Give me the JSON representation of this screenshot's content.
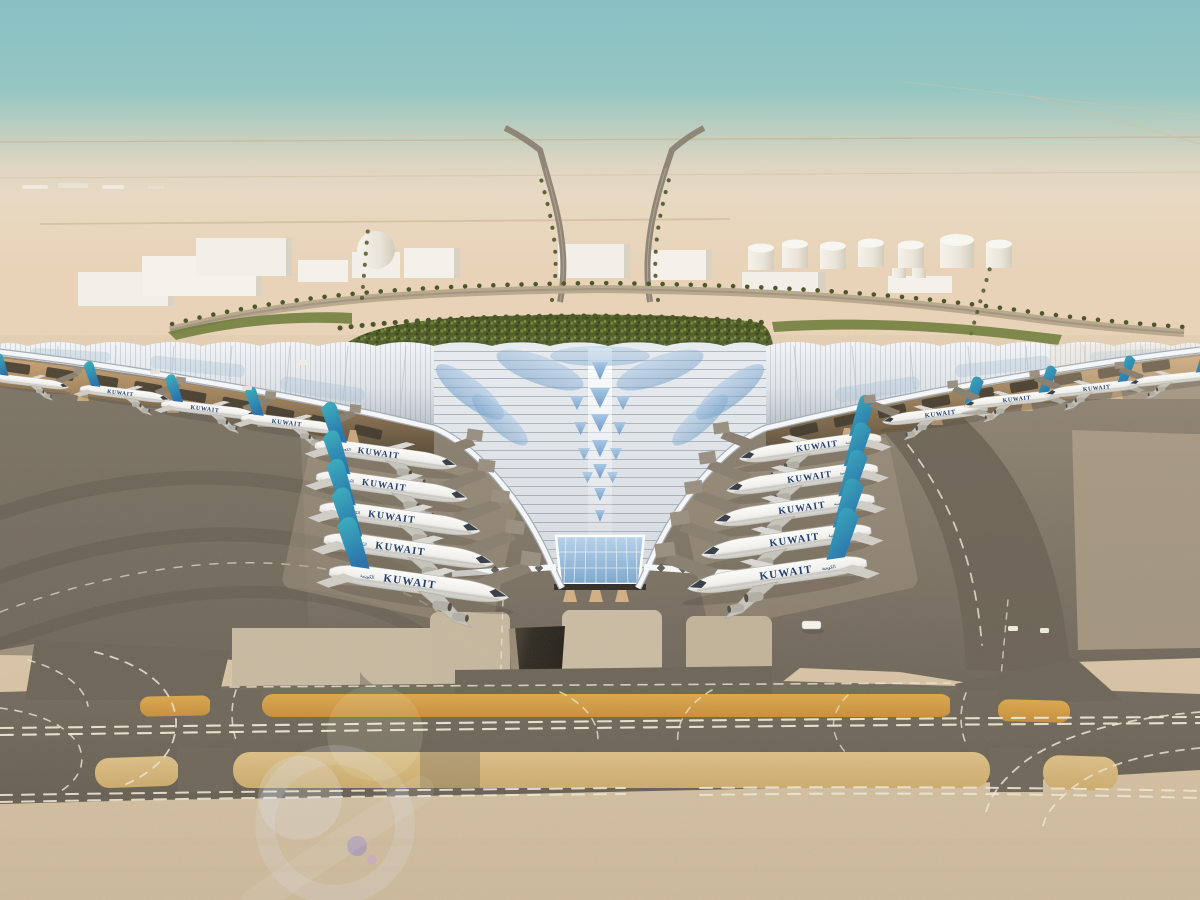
{
  "airline": {
    "title": "KUWAIT",
    "arabic_mark": "الكويتية"
  },
  "scene": {
    "subject": "aerial-rendering-kuwait-airport-terminal",
    "sky": "hazy desert sky",
    "terminal_roof": "white ribbed trefoil canopy with blue glazing chevrons",
    "aircraft_livery": "white fuselage, teal-blue tail"
  },
  "colors": {
    "sky-top": "#88c1c4",
    "sky-haze": "#e8d9c2",
    "sand-far": "#e7d3b7",
    "sand-fore": "#dbc9ac",
    "sand-deep": "#cfbc9e",
    "road-tan": "#c8b193",
    "building-white": "#f2efe8",
    "green-dark": "#4d5c26",
    "green-mid": "#6a7a36",
    "palm": "#4d5729",
    "roof-silver": "#e9edf0",
    "roof-shade": "#b9c1c9",
    "beam-white": "#f4f6f7",
    "glazing-light": "#b9d2ea",
    "glazing-blue": "#7fa8cc",
    "glazing-deep": "#5b83ad",
    "soffit-gold": "#c9a475",
    "soffit-dark": "#564a39",
    "column-tan": "#d0b084",
    "apron-mid": "#958a79",
    "apron-dark": "#6e665a",
    "apron-deep": "#5f584c",
    "stand-light": "#cbbda4",
    "corridor-dark": "#6f675a",
    "mark-white": "#f2ebd9",
    "mark-yellow": "#dfa94e",
    "mark-yellow-deep": "#c8923c",
    "tunnel-dark": "#3b352b",
    "fuselage-white": "#fafaf8",
    "tail-teal": "#3fb3bd",
    "tail-blue": "#2b74ad",
    "title-navy": "#24406e",
    "flare-blue": "#dfe6f5"
  }
}
